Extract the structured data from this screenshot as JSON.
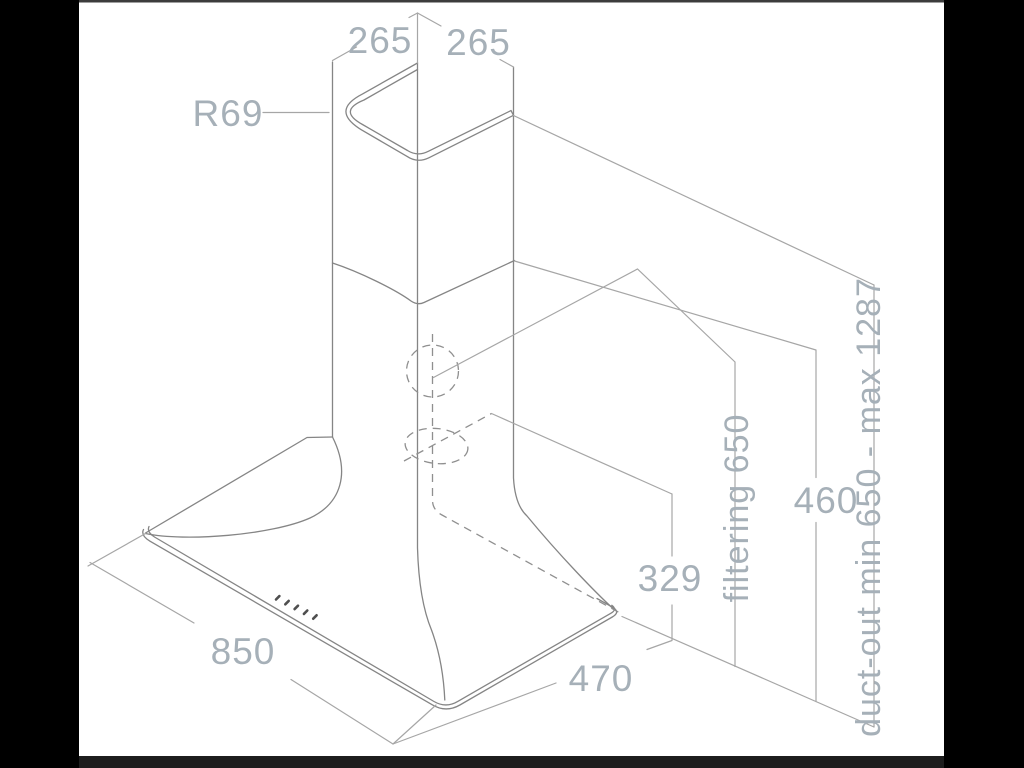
{
  "drawing": {
    "description": "isometric dimensional line drawing of a wall-mounted chimney cooker hood",
    "dimensions": {
      "chimney_top_left_width": "265",
      "chimney_top_right_depth": "265",
      "chimney_corner_radius": "R69",
      "canopy_width": "850",
      "canopy_depth": "470",
      "rear_duct_height": "329",
      "lower_section_height": "460",
      "filtering_clearance": "filtering 650",
      "duct_out_clearance": "duct-out min 650 - max 1287"
    },
    "colors": {
      "background": "#ffffff",
      "letterbox_side": "#000000",
      "letterbox_bottom": "#1d1d1d",
      "letterbox_top": "#3c3c3c",
      "outline": "#858585",
      "dimension_line": "#a6a6a6",
      "hidden_line": "#8f8f8f",
      "label_text": "#a6b0b8",
      "button_marks": "#4f4f4f"
    }
  }
}
